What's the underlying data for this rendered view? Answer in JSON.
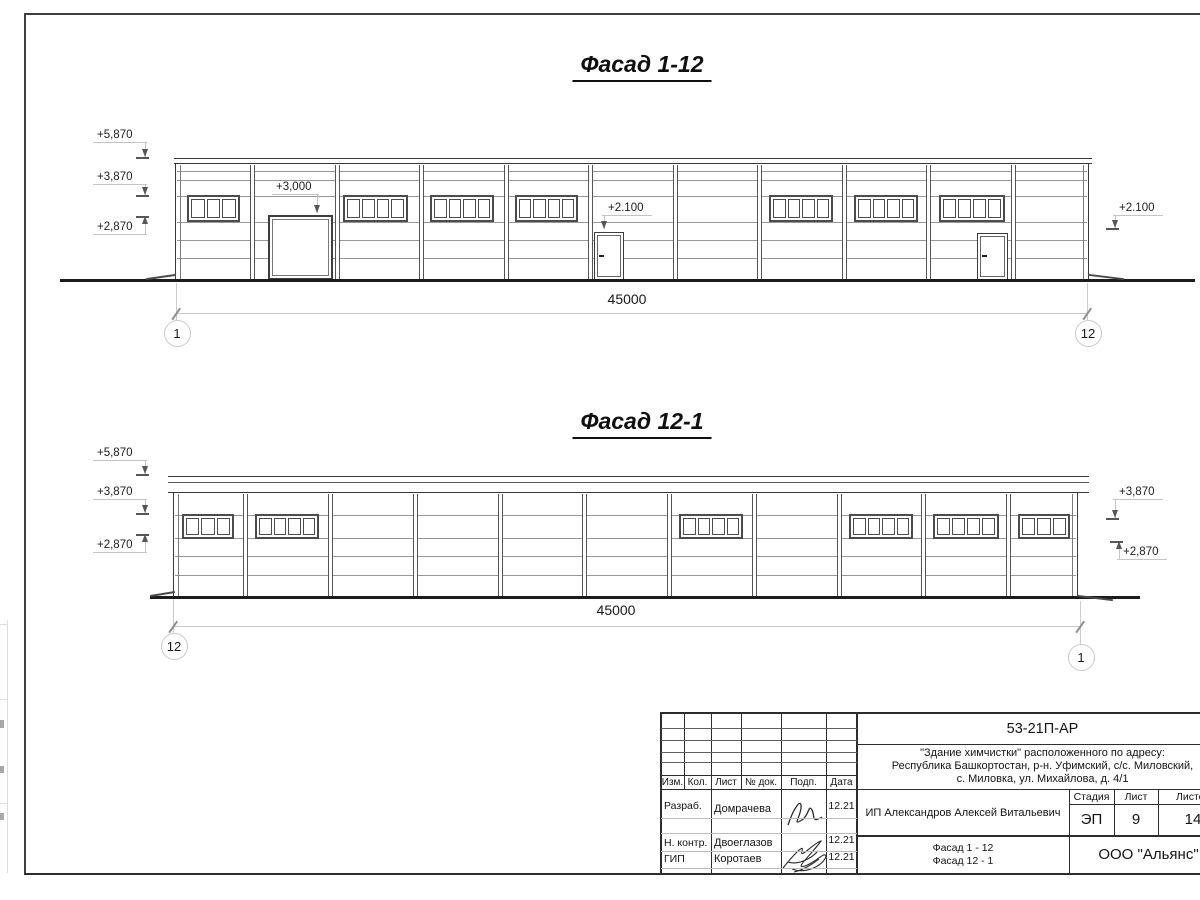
{
  "facades": [
    {
      "id": "facade-1-12",
      "title": "Фасад 1-12",
      "bld": {
        "x1": 175,
        "x2": 1089,
        "roof_x1": 174,
        "roof_x2": 1092,
        "roof_y": 158,
        "wall_y": 164,
        "gnd": 278.5,
        "roof_inner": null,
        "cols": [
          252,
          337,
          421.5,
          506,
          590.5,
          675,
          759.5,
          844,
          928.5,
          1013
        ],
        "lines": [
          171,
          180,
          196,
          222,
          240,
          258
        ]
      },
      "win_y": 195,
      "win_h": 27,
      "windows": [
        {
          "x": 187,
          "w": 53,
          "p": 3
        },
        {
          "x": 343,
          "w": 65,
          "p": 4
        },
        {
          "x": 430,
          "w": 64,
          "p": 4
        },
        {
          "x": 515,
          "w": 63,
          "p": 4
        },
        {
          "x": 769,
          "w": 64,
          "p": 4
        },
        {
          "x": 854,
          "w": 64,
          "p": 4
        },
        {
          "x": 939,
          "w": 66,
          "p": 4
        }
      ],
      "gate": {
        "x": 268,
        "w": 65,
        "y": 215
      },
      "doors": [
        {
          "x": 594,
          "w": 30,
          "y": 231.5
        },
        {
          "x": 977,
          "w": 31,
          "y": 232.5
        }
      ],
      "ground": {
        "x1": 60,
        "x2": 1195,
        "y": 278.5
      },
      "ramps": [
        {
          "x": 146,
          "y": 276,
          "w": 30,
          "a": -8
        },
        {
          "x": 1088,
          "y": 275.5,
          "w": 36,
          "a": 7
        }
      ],
      "marks": [
        {
          "t": "+5,870",
          "x": 97,
          "y": 129,
          "lx": 145,
          "end": "right",
          "dir": "down",
          "ty": 157,
          "tick": true
        },
        {
          "t": "+3,870",
          "x": 97,
          "y": 171,
          "lx": 145,
          "end": "right",
          "dir": "down",
          "ty": 195,
          "tick": true
        },
        {
          "t": "+2,870",
          "x": 97,
          "y": 221,
          "lx": 145,
          "end": "right",
          "dir": "up",
          "ty": 216,
          "tick": true
        },
        {
          "t": "+3,000",
          "x": 276,
          "y": 181,
          "lx": 317,
          "end": "right",
          "dir": "down",
          "ty": 213,
          "tick": false
        },
        {
          "t": "+2.100",
          "x": 608,
          "y": 202,
          "lx": 604,
          "end": "left",
          "dir": "down",
          "ty": 229,
          "tick": false
        },
        {
          "t": "+2.100",
          "x": 1119,
          "y": 202,
          "lx": 1115,
          "end": "left",
          "dir": "down",
          "ty": 228,
          "tick": true
        }
      ],
      "dim": {
        "t": "45000",
        "tx": 627,
        "ty": 291,
        "ly": 313,
        "x1": 176,
        "x2": 1087,
        "ext": [
          {
            "x": 176,
            "y1": 283,
            "y2": 319.5
          },
          {
            "x": 1087,
            "y1": 283,
            "y2": 319.5
          }
        ],
        "circles": [
          {
            "t": "1",
            "cx": 176,
            "cy": 332
          },
          {
            "t": "12",
            "cx": 1087,
            "cy": 332
          }
        ]
      }
    },
    {
      "id": "facade-12-1",
      "title": "Фасад 12-1",
      "bld": {
        "x1": 173,
        "x2": 1078,
        "roof_x1": 168,
        "roof_x2": 1089,
        "roof_y": 476,
        "wall_y": 493,
        "gnd": 595.5,
        "roof_inner": 481,
        "cols": [
          245,
          330,
          415,
          500,
          584.5,
          669,
          754,
          839,
          923.5,
          1008
        ],
        "lines": [
          515,
          538,
          556,
          575
        ]
      },
      "win_y": 514,
      "win_h": 25,
      "windows": [
        {
          "x": 182,
          "w": 52,
          "p": 3
        },
        {
          "x": 255,
          "w": 64,
          "p": 4
        },
        {
          "x": 679,
          "w": 64,
          "p": 4
        },
        {
          "x": 849,
          "w": 64,
          "p": 4
        },
        {
          "x": 933,
          "w": 66,
          "p": 4
        },
        {
          "x": 1018,
          "w": 52,
          "p": 3
        }
      ],
      "gate": null,
      "doors": [],
      "ground": {
        "x1": 150,
        "x2": 1140,
        "y": 595.5
      },
      "ramps": [
        {
          "x": 150,
          "y": 592.5,
          "w": 25,
          "a": -9
        },
        {
          "x": 1077,
          "y": 597,
          "w": 36,
          "a": 7
        }
      ],
      "marks": [
        {
          "t": "+5,870",
          "x": 97,
          "y": 447,
          "lx": 145,
          "end": "right",
          "dir": "down",
          "ty": 474,
          "tick": true
        },
        {
          "t": "+3,870",
          "x": 97,
          "y": 486,
          "lx": 145,
          "end": "right",
          "dir": "down",
          "ty": 513,
          "tick": true
        },
        {
          "t": "+2,870",
          "x": 97,
          "y": 539,
          "lx": 145,
          "end": "right",
          "dir": "up",
          "ty": 534,
          "tick": true
        },
        {
          "t": "+3,870",
          "x": 1119,
          "y": 486,
          "lx": 1115,
          "end": "left",
          "dir": "down",
          "ty": 518,
          "tick": true
        },
        {
          "t": "+2,870",
          "x": 1123,
          "y": 546,
          "lx": 1119,
          "end": "left",
          "dir": "up",
          "ty": 541,
          "tick": true
        }
      ],
      "dim": {
        "t": "45000",
        "tx": 616,
        "ty": 602,
        "ly": 626,
        "x1": 173,
        "x2": 1080,
        "ext": [
          {
            "x": 173,
            "y1": 599,
            "y2": 632.5
          },
          {
            "x": 1080,
            "y1": 601,
            "y2": 643.5
          }
        ],
        "circles": [
          {
            "t": "12",
            "cx": 173,
            "cy": 645
          },
          {
            "t": "1",
            "cx": 1080,
            "cy": 656
          }
        ]
      }
    }
  ],
  "titleblock": {
    "doc_number": "53-21П-АР",
    "address_line1": "\"Здание химчистки\" расположенного по адресу:",
    "address_line2": "Республика Башкортостан, р-н. Уфимский, с/с. Миловский,",
    "address_line3": "с. Миловка, ул. Михайлова, д. 4/1",
    "client": "ИП Александров Алексей Витальевич",
    "columns": {
      "izm": "Изм.",
      "kol": "Кол.",
      "list": "Лист",
      "ndok": "№ док.",
      "podp": "Подп.",
      "data": "Дата"
    },
    "rows": [
      {
        "role": "Разраб.",
        "name": "Домрачева",
        "date": "12.21"
      },
      {
        "role": "Н. контр.",
        "name": "Двоеглазов",
        "date": "12.21"
      },
      {
        "role": "ГИП",
        "name": "Коротаев",
        "date": "12.21"
      }
    ],
    "stage_header": "Стадия",
    "sheet_header": "Лист",
    "sheets_header": "Листов",
    "stage": "ЭП",
    "sheet": "9",
    "sheets": "14",
    "drawing_name_line1": "Фасад 1 - 12",
    "drawing_name_line2": "Фасад 12 - 1",
    "company": "ООО \"Альянс\""
  },
  "colors": {
    "line": "#2d2d2d",
    "light_line": "#c4c4c4",
    "paper": "#ffffff"
  }
}
